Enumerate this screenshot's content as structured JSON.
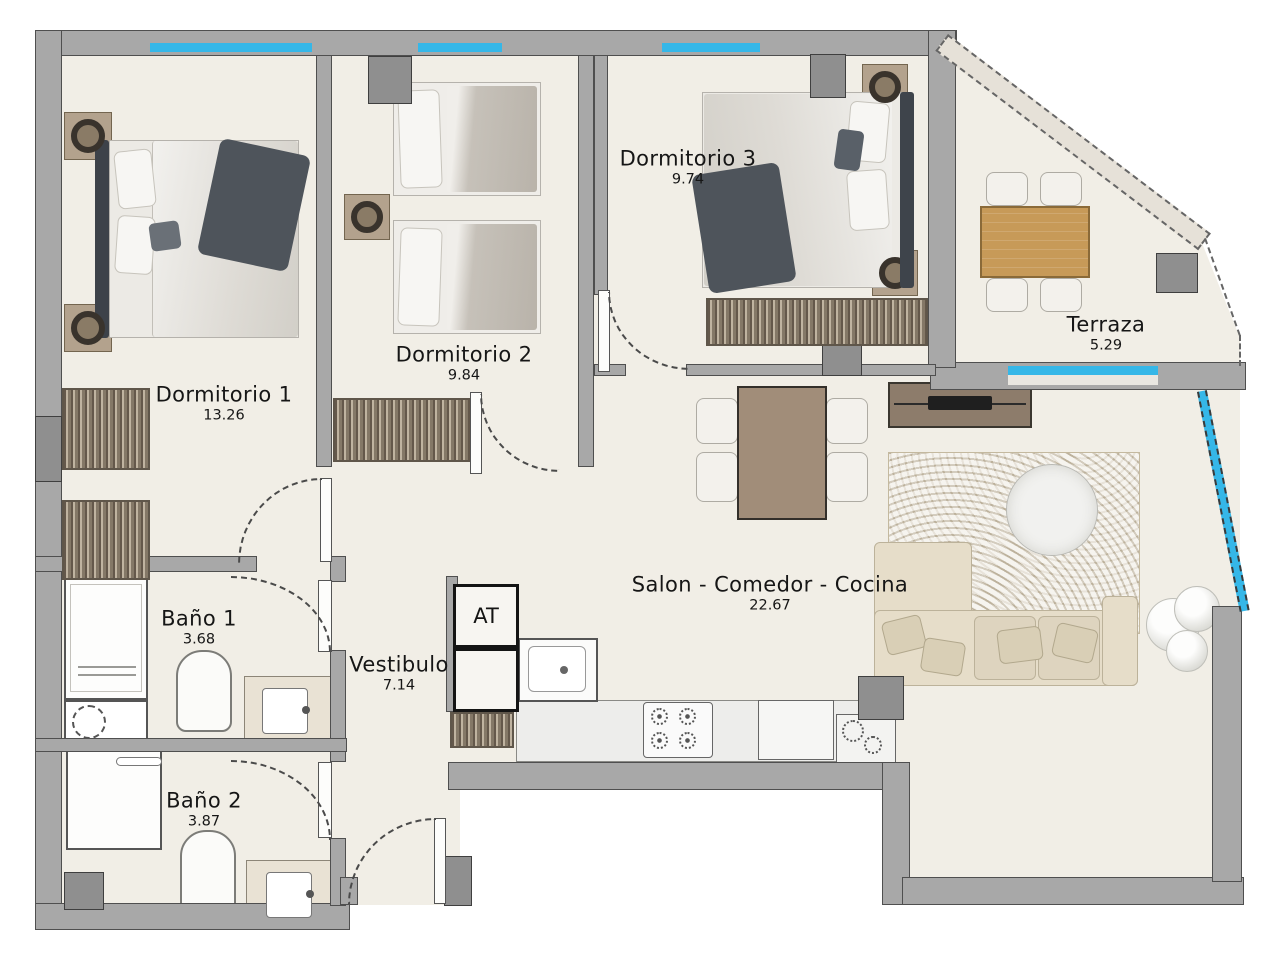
{
  "plan": {
    "rooms": [
      {
        "name": "Dormitorio 1",
        "area": "13.26"
      },
      {
        "name": "Dormitorio 2",
        "area": "9.84"
      },
      {
        "name": "Dormitorio 3",
        "area": "9.74"
      },
      {
        "name": "Terraza",
        "area": "5.29"
      },
      {
        "name": "Salon - Comedor - Cocina",
        "area": "22.67"
      },
      {
        "name": "Baño 1",
        "area": "3.68"
      },
      {
        "name": "Baño 2",
        "area": "3.87"
      },
      {
        "name": "Vestibulo",
        "area": "7.14"
      }
    ],
    "shaft_label": "AT",
    "colors": {
      "wall": "#a8a8a8",
      "wall_outline": "#4f4f4f",
      "floor": "#f1eee6",
      "window_glass": "#35b7e8",
      "terrace_wood": "#c79a58",
      "table_taupe": "#a18d79",
      "rug": "#dbd1bd",
      "sofa": "#e6ddc9",
      "dark_textile": "#4e545b",
      "wardrobe": "#9b8d7b"
    }
  }
}
